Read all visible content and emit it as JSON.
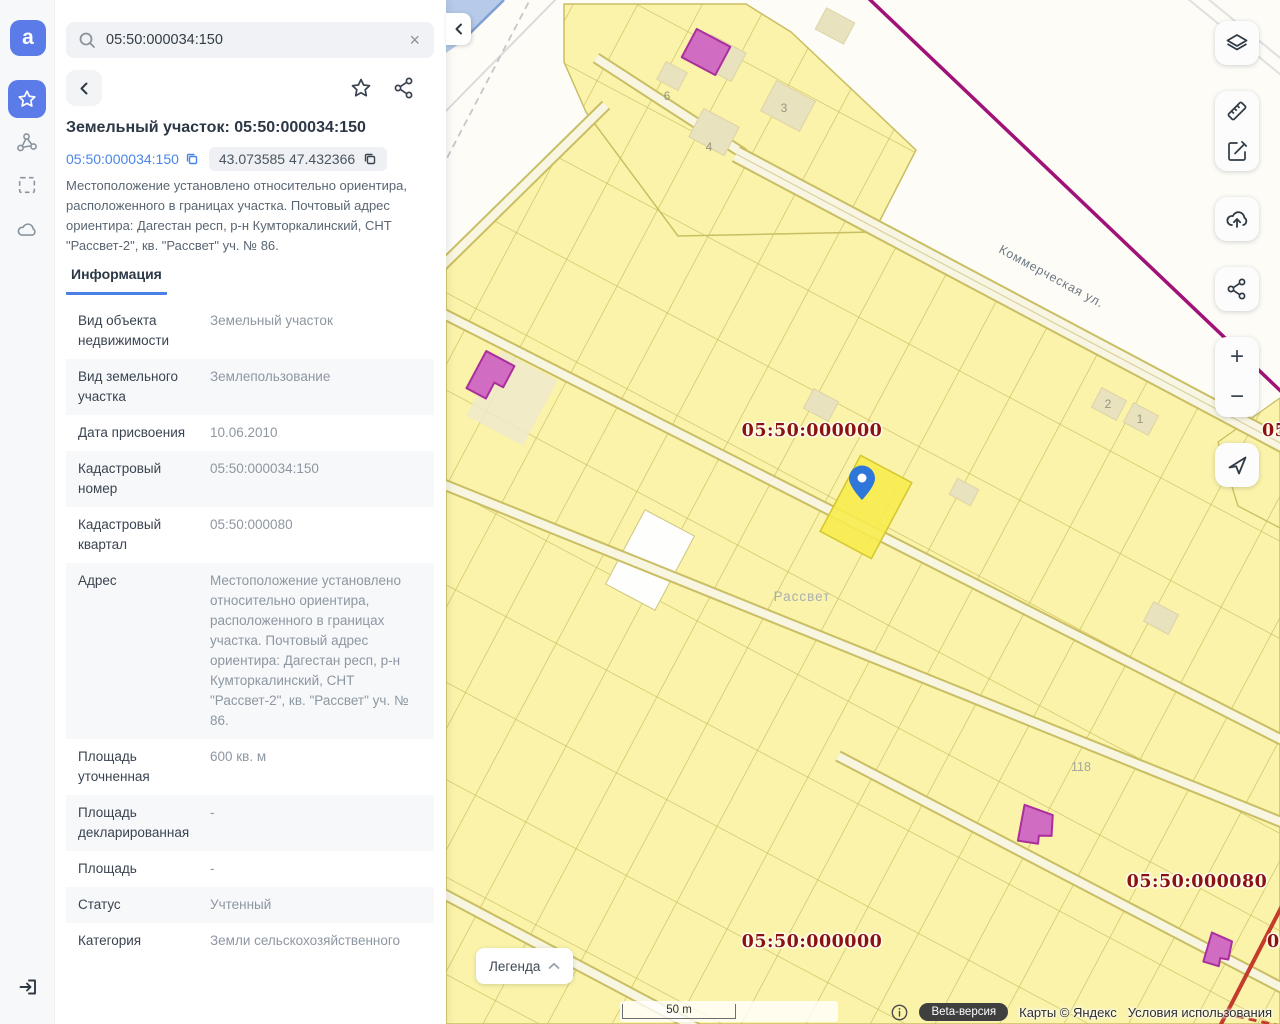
{
  "search": {
    "value": "05:50:000034:150"
  },
  "panel": {
    "title": "Земельный участок: 05:50:000034:150",
    "cadastral_chip": "05:50:000034:150",
    "coords_chip": "43.073585 47.432366",
    "description": "Местоположение установлено относительно ориентира, расположенного в границах участка. Почтовый адрес ориентира: Дагестан респ, р-н Кумторкалинский, СНТ \"Рассвет-2\", кв. \"Рассвет\" уч. № 86.",
    "tab_label": "Информация",
    "info_rows": [
      {
        "label": "Вид объекта недвижимости",
        "value": "Земельный участок"
      },
      {
        "label": "Вид земельного участка",
        "value": "Землепользование"
      },
      {
        "label": "Дата присвоения",
        "value": "10.06.2010"
      },
      {
        "label": "Кадастровый номер",
        "value": "05:50:000034:150"
      },
      {
        "label": "Кадастровый квартал",
        "value": "05:50:000080"
      },
      {
        "label": "Адрес",
        "value": "Местоположение установлено относительно ориентира, расположенного в границах участка. Почтовый адрес ориентира: Дагестан респ, р-н Кумторкалинский, СНТ \"Рассвет-2\", кв. \"Рассвет\" уч. № 86."
      },
      {
        "label": "Площадь уточненная",
        "value": "600 кв. м"
      },
      {
        "label": "Площадь декларированная",
        "value": "-"
      },
      {
        "label": "Площадь",
        "value": "-"
      },
      {
        "label": "Статус",
        "value": "Учтенный"
      },
      {
        "label": "Категория",
        "value": "Земли сельскохозяйственного"
      }
    ]
  },
  "map": {
    "legend_label": "Легенда",
    "scale_label": "50 m",
    "street_label": "Коммерческая ул.",
    "settlement_label": "Рассвет",
    "quarter_labels": [
      "05:50:000000",
      "05:50:000080",
      "05:50:000000"
    ],
    "edge_labels": [
      "05:5",
      "05:"
    ],
    "parcel_numbers": [
      "6",
      "3",
      "4",
      "2",
      "1",
      "118"
    ],
    "attribution": {
      "beta": "Beta-версия",
      "maps": "Карты © Яндекс",
      "terms": "Условия использования"
    },
    "colors": {
      "parcel_fill": "#FAF3A9",
      "parcel_border": "#C9BE62",
      "selected_parcel": "#F7EC4E",
      "quarter_label": "#8C1211",
      "boundary_purple": "#A01277",
      "boundary_red": "#C23B2B",
      "building_pink": "#D06CC2",
      "building_beige": "#E9E2BF",
      "pin_blue": "#2E76D9",
      "accent_blue": "#5B7CE8",
      "water": "#B7CAEA"
    }
  },
  "icons": [
    "app-logo",
    "search",
    "clear",
    "back-chevron",
    "favorite-star",
    "share",
    "copy",
    "polygon-nodes",
    "select-area",
    "cloud",
    "exit",
    "collapse-chevron",
    "layers",
    "ruler",
    "edit",
    "cloud-upload",
    "map-share",
    "zoom-in",
    "zoom-out",
    "locate-arrow",
    "legend-chevron-up",
    "info",
    "map-pin"
  ]
}
